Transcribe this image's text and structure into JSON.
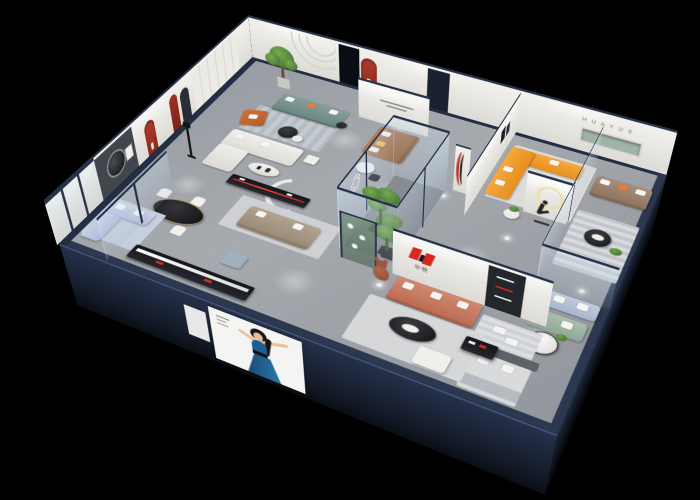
{
  "scene": {
    "description": "Isometric 3D cutaway render of a furniture showroom apartment, viewed from above on a black background",
    "background": "#000000"
  },
  "brand": {
    "logo_text": "华悦",
    "logo_mark": "huayue-logo-icon",
    "wall_lettering": "H U A Y U E"
  },
  "colors": {
    "outer_wall_navy": "#232e44",
    "inner_wall_white": "#f0efec",
    "floor_gray": "#9ba0a6",
    "brand_red": "#d6281e",
    "arch_red": "#b23b2a",
    "sofa_orange": "#f29a2e",
    "sofa_teal": "#7c9693",
    "sofa_terracotta": "#c97a60",
    "sofa_leather_brown": "#a9744a",
    "sofa_taupe": "#9b8573",
    "sofa_lavender": "#c3cce4",
    "sofa_sage": "#a0b5a5",
    "sofa_lightblue": "#b4c3d8",
    "shelf_green": "#9fb4a6",
    "plant_green": "#55833f",
    "poster_dress_blue": "#1d5f93"
  },
  "objects": [
    "teal-fabric-sofa",
    "orange-leather-armchair",
    "potted-tree",
    "white-boucle-sectional",
    "black-media-console",
    "brown-fabric-sofa",
    "dining-table-black-oval",
    "dining-chairs",
    "red-arch-niche",
    "wardrobe-wall",
    "black-floor-lamp",
    "lavender-sofa-set",
    "glass-corner-lounge",
    "long-black-display-cabinet",
    "woman-poster-panel",
    "glass-atrium-with-plants",
    "orange-l-shaped-sectional",
    "marble-coffee-table",
    "runner-statue-with-ring-light",
    "white-column-red-stripe",
    "taupe-sofa",
    "green-recessed-shelf",
    "round-black-coffee-table",
    "glass-partitions",
    "lightblue-loveseat",
    "sage-green-loveseat",
    "round-white-coffee-table",
    "gray-display-bed",
    "terracotta-sofa",
    "logo-wall",
    "black-oval-coffee-table",
    "white-ottoman",
    "teddy-bear-sculpture",
    "green-display-case",
    "ceiling-downlights"
  ]
}
